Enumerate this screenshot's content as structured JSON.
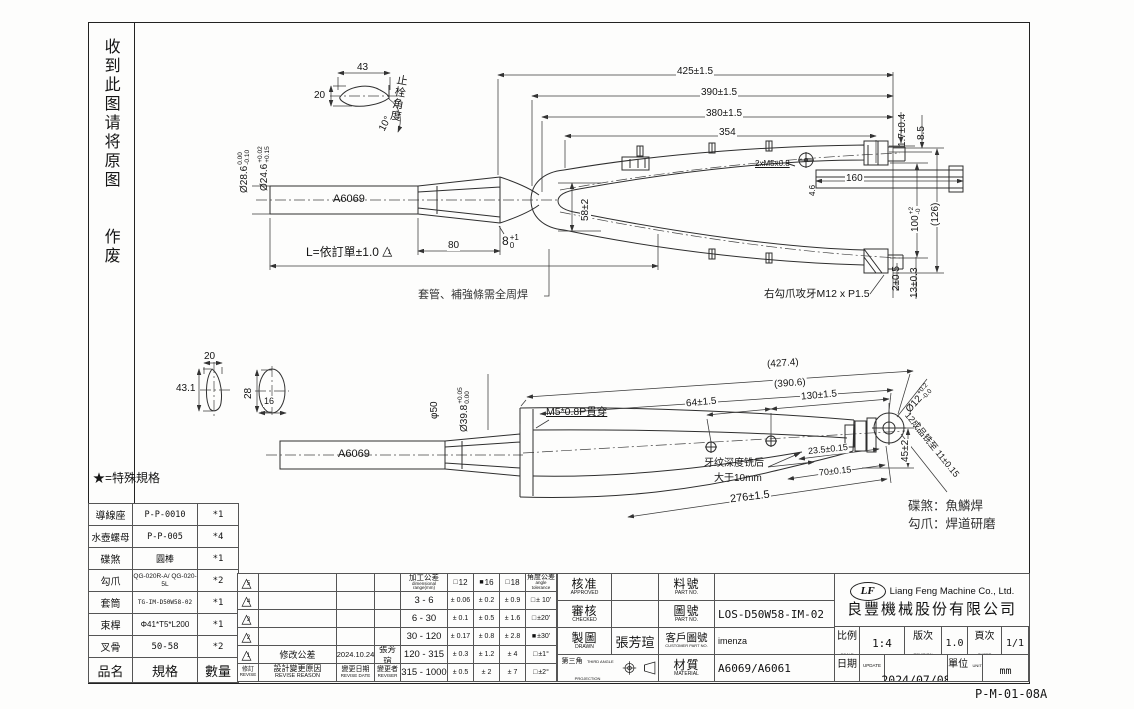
{
  "sidebar": {
    "line1": "收到此图请将原图",
    "line2": "作废"
  },
  "top": {
    "d425": "425±1.5",
    "d390": "390±1.5",
    "d380": "380±1.5",
    "d354": "354",
    "d17": "1.7±0.4",
    "d85": "8.5",
    "d160": "160",
    "d100": {
      "main": "100",
      "up": "+2",
      "lo": "-0"
    },
    "d126": "(126)",
    "d2": "2±0.5",
    "d13": "13±0.3",
    "hook_note": "右勾爪攻牙M12 x P1.5",
    "m5": "2xM5x0.8",
    "d46": "4.6",
    "d58": "58±2",
    "d8": {
      "main": "8",
      "up": "+1",
      "lo": "0"
    },
    "d80": "80",
    "length_note": "L=依訂單±1.0",
    "length_tri": "1",
    "weld_note": "套管、補強條需全周焊",
    "d286": {
      "main": "Ø28.6",
      "up": "0.00",
      "lo": "-0.10"
    },
    "d246": {
      "main": "Ø24.6",
      "up": "+0.02",
      "lo": "+0.15"
    },
    "material": "A6069",
    "det43": "43",
    "det20": "20",
    "angle": "10°",
    "angle_label": "止栓角度"
  },
  "bottom": {
    "d4274": "(427.4)",
    "d3906": "(390.6)",
    "d64": "64±1.5",
    "d130": "130±1.5",
    "d12": {
      "main": "Ø12",
      "up": "+0.2",
      "lo": "-0.0"
    },
    "m5thru": "M5*0.8P貫穿",
    "d50": "φ50",
    "d398": {
      "main": "Ø39.8",
      "up": "+0.05",
      "lo": "0.00"
    },
    "d45": "45±2",
    "d235": "23.5±0.15",
    "d70": "70±0.15",
    "d276": "276±1.5",
    "thread_note1": "牙纹深度铣后",
    "thread_note2": "大于10mm",
    "mill_note": "12成品铣至 11±0.15",
    "finish_note1": "碟煞：魚鱗焊",
    "finish_note2": "勾爪：焊道研磨",
    "material": "A6069",
    "det20": "20",
    "det431": "43.1",
    "det28": "28",
    "det16": "16",
    "star_note": "★=特殊規格"
  },
  "parts": {
    "rows": [
      {
        "name": "導線座",
        "spec": "P-P-0010",
        "qty": "*1"
      },
      {
        "name": "水壺螺母",
        "spec": "P-P-005",
        "qty": "*4"
      },
      {
        "name": "碟煞",
        "spec": "圓棒",
        "qty": "*1"
      },
      {
        "name": "勾爪",
        "spec": "QG-020R-A/ QG-020-5L",
        "qty": "*2"
      },
      {
        "name": "套筒",
        "spec": "TG-IM-D50W58-02",
        "qty": "*1"
      },
      {
        "name": "束桿",
        "spec": "Φ41*T5*L200",
        "qty": "*1"
      },
      {
        "name": "叉骨",
        "spec": "50-58",
        "qty": "*2"
      }
    ],
    "header": {
      "name": "品名",
      "spec": "規格",
      "qty": "數量"
    }
  },
  "revision": {
    "rows": [
      {
        "no": "5",
        "reason": "",
        "date": "",
        "by": ""
      },
      {
        "no": "4",
        "reason": "",
        "date": "",
        "by": ""
      },
      {
        "no": "3",
        "reason": "",
        "date": "",
        "by": ""
      },
      {
        "no": "2",
        "reason": "",
        "date": "",
        "by": ""
      },
      {
        "no": "1",
        "reason": "修改公差",
        "date": "2024.10.24",
        "by": "張芳瑄"
      }
    ],
    "header": {
      "no_zh": "修訂",
      "no_en": "REVISE",
      "reason_zh": "設計變更原因",
      "reason_en": "REVISE REASON",
      "date_zh": "變更日期",
      "date_en": "REVISE DATE",
      "by_zh": "變更者",
      "by_en": "REVISER"
    }
  },
  "tolerance": {
    "header": {
      "range_zh": "加工公差",
      "range_en": "dimensional range(mm)",
      "g12_box": "□",
      "g12": "12",
      "g16_box": "■",
      "g16": "16",
      "g18_box": "□",
      "g18": "18",
      "angle_zh": "角度公差",
      "angle_en": "angle tolerance"
    },
    "rows": [
      {
        "range": "3 - 6",
        "t12": "± 0.06",
        "t16": "± 0.2",
        "t18": "± 0.9",
        "box": "□",
        "angle": "± 10'"
      },
      {
        "range": "6 - 30",
        "t12": "± 0.1",
        "t16": "± 0.5",
        "t18": "± 1.6",
        "box": "□",
        "angle": "±20'"
      },
      {
        "range": "30 - 120",
        "t12": "± 0.17",
        "t16": "± 0.8",
        "t18": "± 2.8",
        "box": "■",
        "angle": "±30'"
      },
      {
        "range": "120 - 315",
        "t12": "± 0.3",
        "t16": "± 1.2",
        "t18": "± 4",
        "box": "□",
        "angle": "±1°"
      },
      {
        "range": "315 - 1000",
        "t12": "± 0.5",
        "t16": "± 2",
        "t18": "± 7",
        "box": "□",
        "angle": "±2°"
      }
    ]
  },
  "title": {
    "approved": {
      "zh": "核准",
      "en": "APPROVED",
      "value": ""
    },
    "checked": {
      "zh": "審核",
      "en": "CHECKED",
      "value": ""
    },
    "drawn": {
      "zh": "製圖",
      "en": "DRAWN",
      "value": "張芳瑄"
    },
    "projection": {
      "zh": "第三角",
      "en": "THIRD ANGLE PROJECTION"
    },
    "part_no": {
      "zh": "料號",
      "en": "PART NO.",
      "value": ""
    },
    "drawing_no": {
      "zh": "圖號",
      "en": "PART NO.",
      "value": "LOS-D50W58-IM-02"
    },
    "customer_no": {
      "zh": "客戶圖號",
      "en": "CUSTOMER PART NO.",
      "value": "imenza"
    },
    "material": {
      "zh": "材質",
      "en": "MATERIAL",
      "value": "A6069/A6061"
    },
    "company": {
      "logo_text": "LF",
      "en": "Liang Feng Machine Co., Ltd.",
      "zh": "良豐機械股份有限公司"
    },
    "scale": {
      "zh": "比例",
      "en": "SCALE",
      "value": "1:4"
    },
    "revision": {
      "zh": "版次",
      "en": "REVISION",
      "value": "1.0"
    },
    "sheet": {
      "zh": "頁次",
      "en": "SHEET",
      "value": "1/1"
    },
    "date": {
      "zh": "日期",
      "en": "DATE",
      "update_label": "UPDATE",
      "date_label": "DATE",
      "value": "2024/07/08"
    },
    "unit": {
      "zh": "單位",
      "en": "UNIT",
      "value": "mm"
    },
    "form_no": "P-M-01-08A"
  }
}
